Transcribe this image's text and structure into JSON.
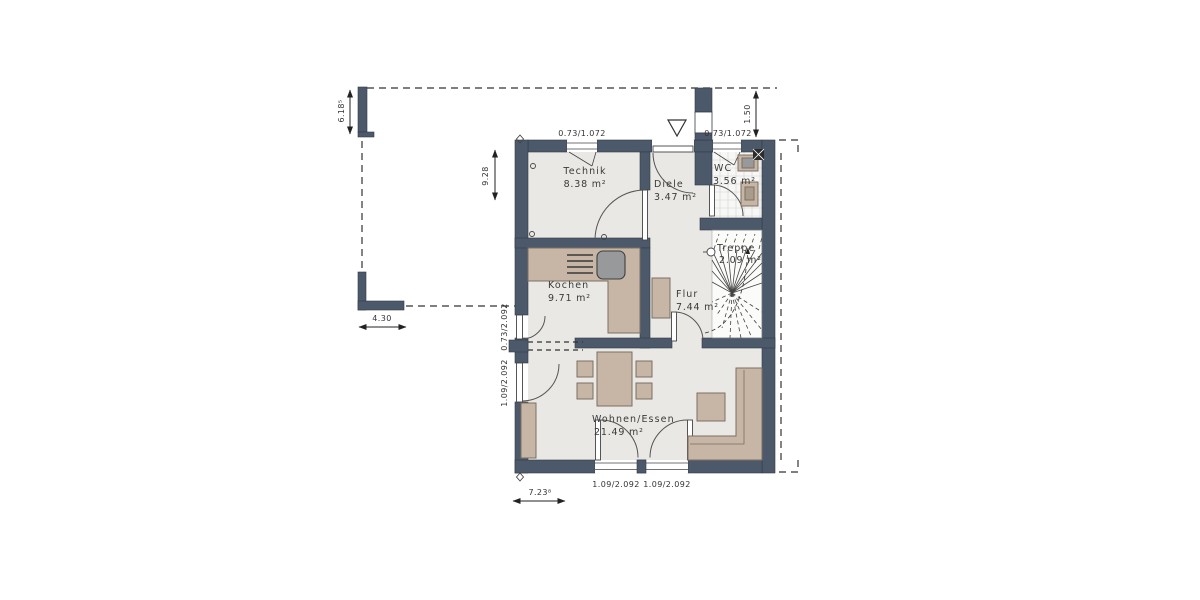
{
  "plan": {
    "title": "Erdgeschoss Grundriss",
    "rooms": [
      {
        "key": "technik",
        "name": "Technik",
        "area": "8.38 m²"
      },
      {
        "key": "diele",
        "name": "Diele",
        "area": "3.47 m²"
      },
      {
        "key": "wc",
        "name": "WC",
        "area": "3.56 m²"
      },
      {
        "key": "treppe",
        "name": "Treppe",
        "area": "2.09 m²"
      },
      {
        "key": "kochen",
        "name": "Kochen",
        "area": "9.71 m²"
      },
      {
        "key": "flur",
        "name": "Flur",
        "area": "7.44 m²"
      },
      {
        "key": "wohnen",
        "name": "Wohnen/Essen",
        "area": "21.49 m²"
      }
    ],
    "dimensions": {
      "site_left": "6.18⁵",
      "house_depth": "9.28",
      "setback_right": "1.50",
      "garden_wall": "4.30",
      "house_width": "7.23⁸",
      "window_technik": "0.73/1.072",
      "window_wc": "0.73/1.072",
      "door_kochen": "0.73/2.092",
      "door_wohnen_side": "1.09/2.092",
      "terrace_door_left": "1.09/2.092",
      "terrace_door_right": "1.09/2.092"
    },
    "colors": {
      "wall": "#4b596b",
      "floor": "#e9e8e4",
      "furniture": "#c7b5a5",
      "tile_floor": "#f7f7f5",
      "stair_floor": "#fbfbf9",
      "sink_gray": "#97999b",
      "line": "#333333"
    }
  }
}
